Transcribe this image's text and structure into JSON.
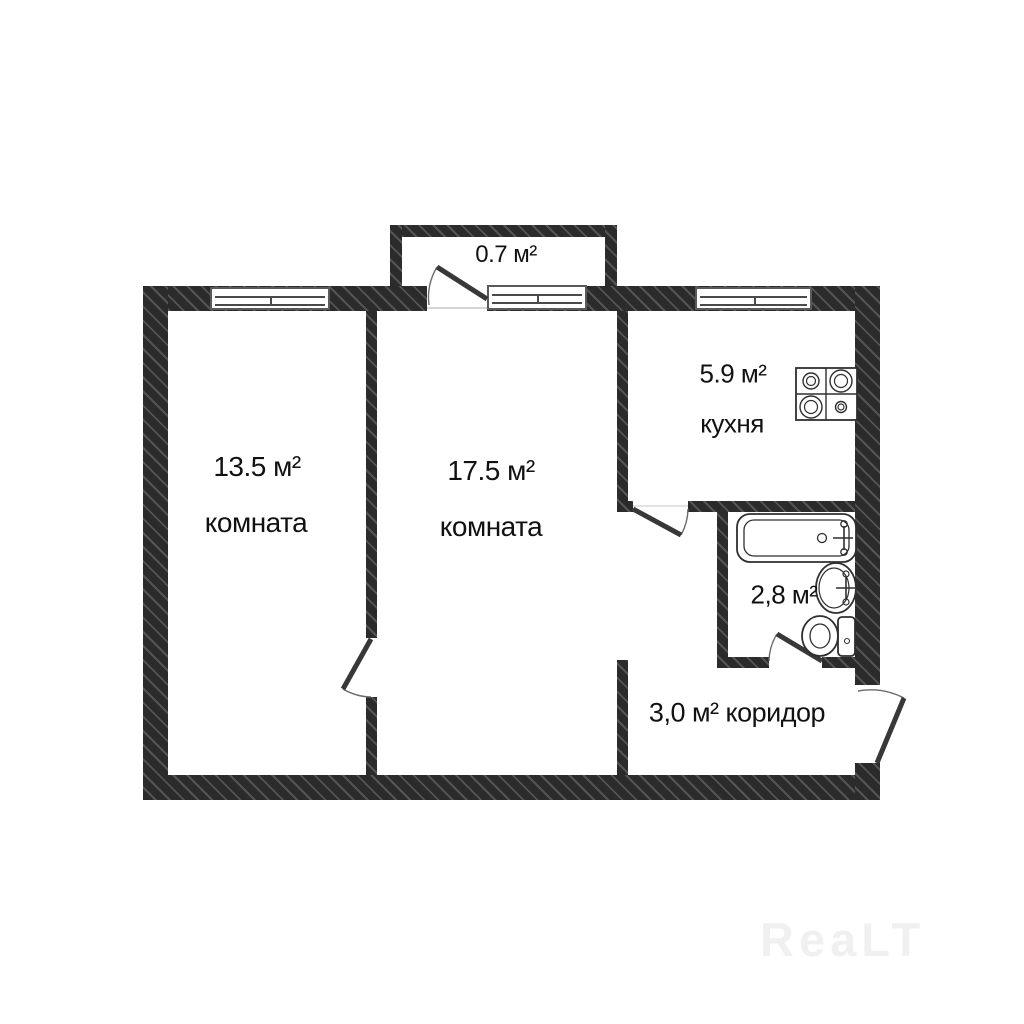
{
  "plan": {
    "balcony": {
      "area": "0.7 м²"
    },
    "room_left": {
      "area": "13.5 м²",
      "name": "комната"
    },
    "room_center": {
      "area": "17.5 м²",
      "name": "комната"
    },
    "kitchen": {
      "area": "5.9 м²",
      "name": "кухня"
    },
    "bathroom": {
      "area": "2,8 м²"
    },
    "corridor": {
      "area": "3,0 м²",
      "name": "коридор"
    }
  },
  "icons": {
    "stove": "stove-icon",
    "bathtub": "bathtub-icon",
    "sink": "sink-icon",
    "toilet": "toilet-icon"
  },
  "watermark": "ReaLT",
  "colors": {
    "wall": "#2b2b2b",
    "wall_hatch": "#545454",
    "line": "#2f2f2f",
    "background": "#ffffff",
    "text": "#111111",
    "watermark": "#f0f0f0"
  }
}
